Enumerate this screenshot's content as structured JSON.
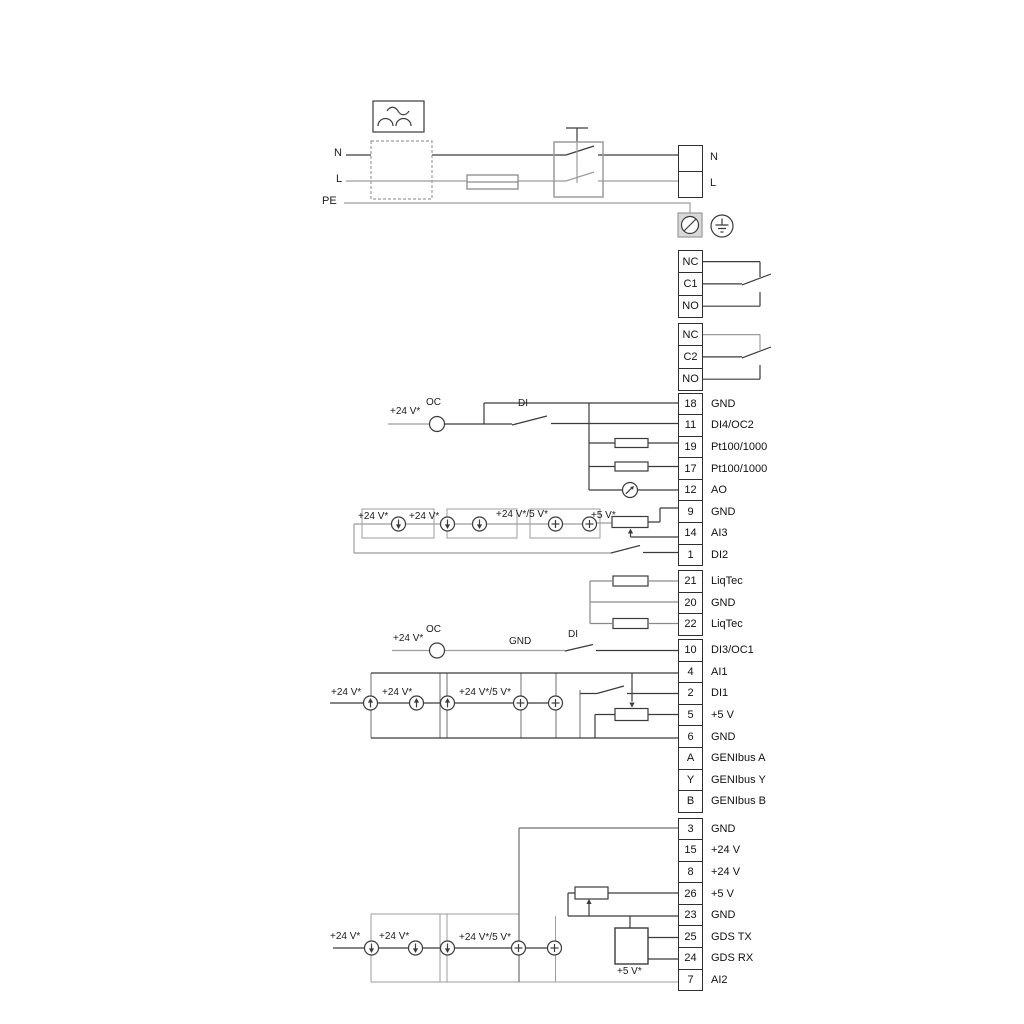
{
  "power": {
    "left_n": "N",
    "left_l": "L",
    "left_pe": "PE",
    "right_n": "N",
    "right_l": "L"
  },
  "relay1": [
    {
      "id": "NC"
    },
    {
      "id": "C1"
    },
    {
      "id": "NO"
    }
  ],
  "relay2": [
    {
      "id": "NC"
    },
    {
      "id": "C2"
    },
    {
      "id": "NO"
    }
  ],
  "io1": [
    {
      "id": "18",
      "label": "GND"
    },
    {
      "id": "11",
      "label": "DI4/OC2"
    },
    {
      "id": "19",
      "label": "Pt100/1000"
    },
    {
      "id": "17",
      "label": "Pt100/1000"
    },
    {
      "id": "12",
      "label": "AO"
    },
    {
      "id": "9",
      "label": "GND"
    },
    {
      "id": "14",
      "label": "AI3"
    },
    {
      "id": "1",
      "label": "DI2"
    }
  ],
  "liqtec": [
    {
      "id": "21",
      "label": "LiqTec"
    },
    {
      "id": "20",
      "label": "GND"
    },
    {
      "id": "22",
      "label": "LiqTec"
    }
  ],
  "io2": [
    {
      "id": "10",
      "label": "DI3/OC1"
    },
    {
      "id": "4",
      "label": "AI1"
    },
    {
      "id": "2",
      "label": "DI1"
    },
    {
      "id": "5",
      "label": "+5 V"
    },
    {
      "id": "6",
      "label": "GND"
    },
    {
      "id": "A",
      "label": "GENIbus A"
    },
    {
      "id": "Y",
      "label": "GENIbus Y"
    },
    {
      "id": "B",
      "label": "GENIbus B"
    }
  ],
  "io3": [
    {
      "id": "3",
      "label": "GND"
    },
    {
      "id": "15",
      "label": "+24 V"
    },
    {
      "id": "8",
      "label": "+24 V"
    },
    {
      "id": "26",
      "label": "+5 V"
    },
    {
      "id": "23",
      "label": "GND"
    },
    {
      "id": "25",
      "label": "GDS TX"
    },
    {
      "id": "24",
      "label": "GDS RX"
    },
    {
      "id": "7",
      "label": "AI2"
    }
  ],
  "labels": {
    "a_supply": "+24 V*",
    "a_oc": "OC",
    "a_di": "DI",
    "b_supply1": "+24 V*",
    "b_supply2": "+24 V*",
    "b_supply3": "+24 V*/5 V*",
    "b_supply4": "+5 V*",
    "oc1_supply": "+24 V*",
    "oc1_oc": "OC",
    "oc1_gnd": "GND",
    "oc1_di": "DI",
    "c_supply1": "+24 V*",
    "c_supply2": "+24 V*",
    "c_supply3": "+24 V*/5 V*",
    "d_supply1": "+24 V*",
    "d_supply2": "+24 V*",
    "d_supply3": "+24 V*/5 V*",
    "d_supply4": "+5 V*"
  }
}
